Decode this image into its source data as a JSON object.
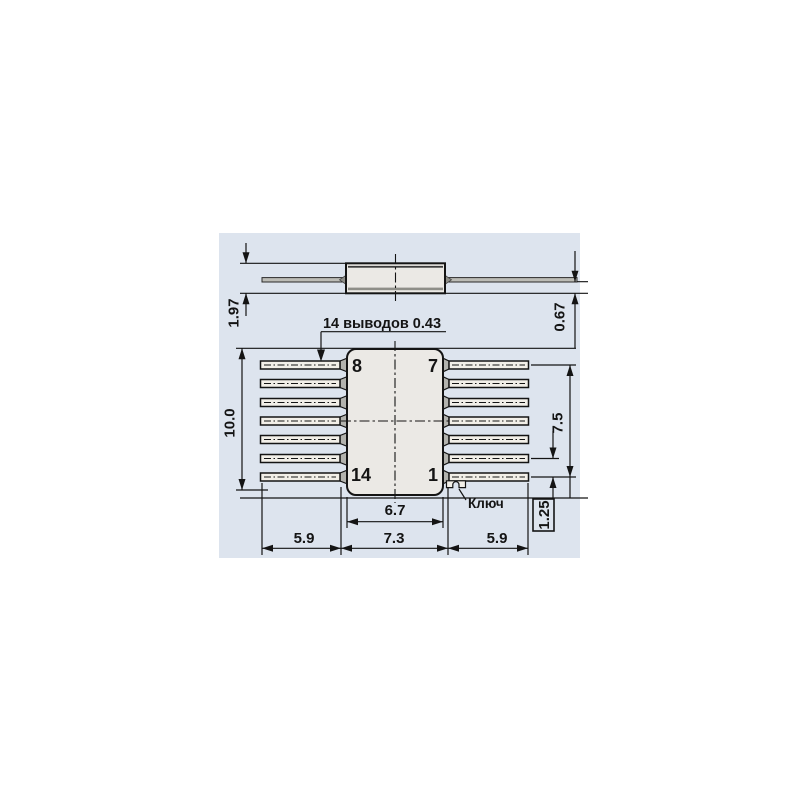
{
  "figure": {
    "colors": {
      "page_bg": "#ffffff",
      "panel_bg": "#dde4ee",
      "ink": "#141414",
      "body_fill": "#ebe9e5",
      "lead_fill": "#f2efe8",
      "flare_fill": "#b3b3ae"
    },
    "side_view": {
      "height_dim": "1.97",
      "lead_offset_dim": "0.67"
    },
    "plan_view": {
      "lead_note": "14 выводов 0.43",
      "key_label": "Ключ",
      "pin_top_left": "8",
      "pin_top_right": "7",
      "pin_bottom_left": "14",
      "pin_bottom_right": "1",
      "dim_overall_width": "10.0",
      "dim_pin_span": "7.5",
      "dim_pitch_boxed": "1.25",
      "dim_body_width": "6.7",
      "dim_tip_span": "7.3",
      "dim_lead_left": "5.9",
      "dim_lead_right": "5.9"
    }
  }
}
